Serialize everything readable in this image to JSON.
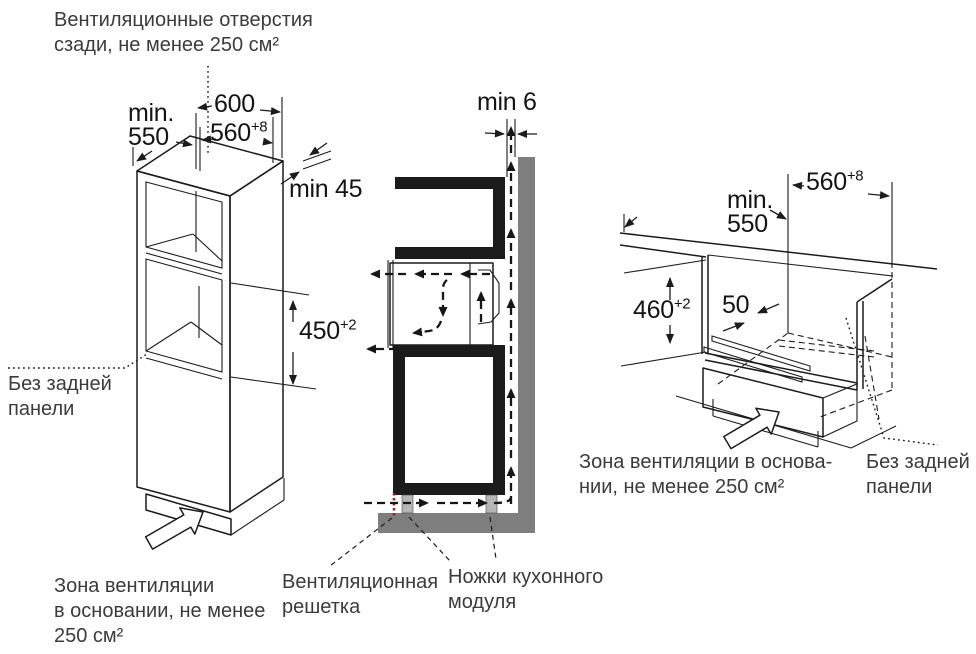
{
  "colors": {
    "ink": "#1c1c1c",
    "label_text": "#3b3b3b",
    "wall_gray": "#7e7e7e",
    "foot_gray": "#b6b6b6",
    "grille_red": "#9b2339",
    "background": "#ffffff"
  },
  "labels": {
    "vent_rear_l1": "Вентиляционные отверстия",
    "vent_rear_l2": "сзади, не менее 250 см²",
    "no_back_left_l1": "Без задней",
    "no_back_left_l2": "панели",
    "zone_left_l1": "Зона вентиляции",
    "zone_left_l2": "в основании, не менее",
    "zone_left_l3": "250 см²",
    "grille_l1": "Вентиляционная",
    "grille_l2": "решетка",
    "feet_l1": "Ножки кухонного",
    "feet_l2": "модуля",
    "zone_right_l1": "Зона вентиляции в основа-",
    "zone_right_l2": "нии, не менее 250 см²",
    "no_back_right_l1": "Без задней",
    "no_back_right_l2": "панели"
  },
  "dims": {
    "left_min": "min.",
    "left_550": "550",
    "left_600": "600",
    "left_560": "560",
    "left_560_sup": "+8",
    "left_min45": "min 45",
    "left_450": "450",
    "left_450_sup": "+2",
    "mid_min6": "min 6",
    "right_min": "min.",
    "right_550": "550",
    "right_560": "560",
    "right_560_sup": "+8",
    "right_460": "460",
    "right_460_sup": "+2",
    "right_50": "50"
  }
}
